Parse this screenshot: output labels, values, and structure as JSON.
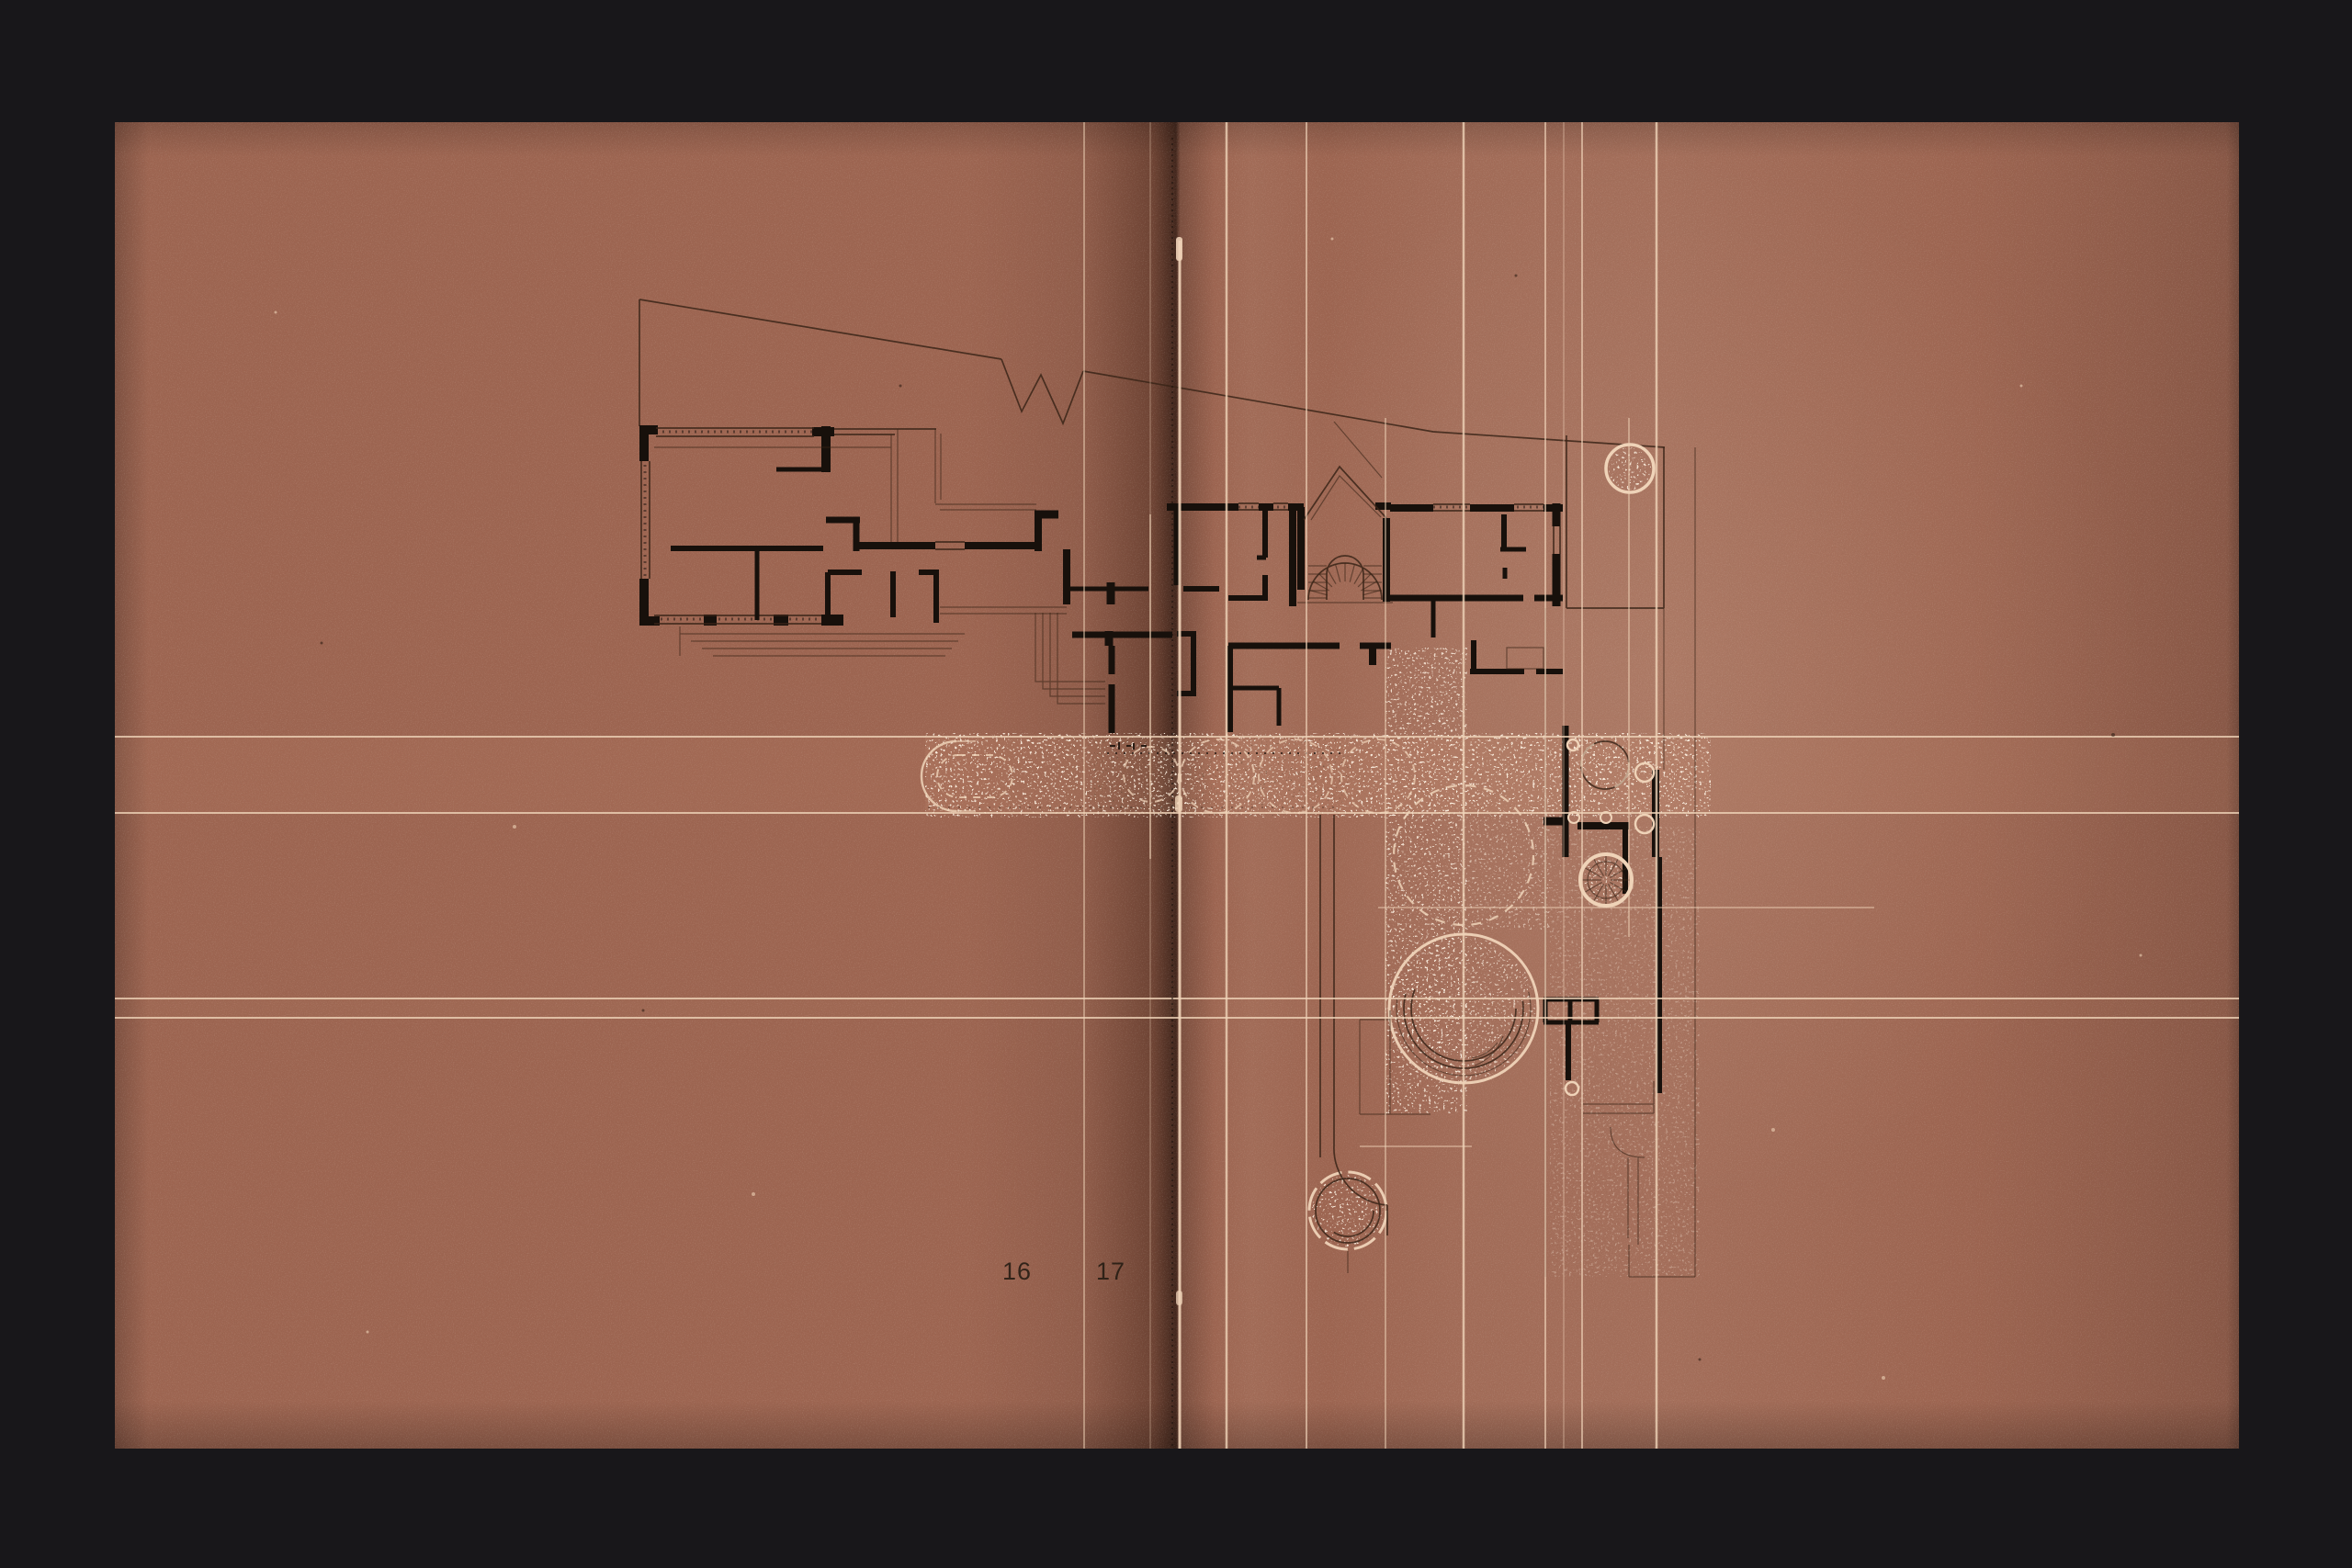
{
  "spread": {
    "left_page_number": "16",
    "right_page_number": "17"
  },
  "plan_symbols": {
    "tree": "tree-symbol",
    "stair": "fan-stair-symbol",
    "driveway": "stippled-driveway-band",
    "terrace": "circular-terrace",
    "pergola": "pergola-grid"
  },
  "colors": {
    "bg": "#18171a",
    "paper": "#9d6551",
    "paper_light": "#aa7059",
    "paper_dark": "#7c4c3b",
    "gutter": "#4f3024",
    "ink": "#17100b",
    "ink_soft": "#3a2418",
    "cream": "#efd3b8",
    "page_number_ink": "#241b12"
  }
}
